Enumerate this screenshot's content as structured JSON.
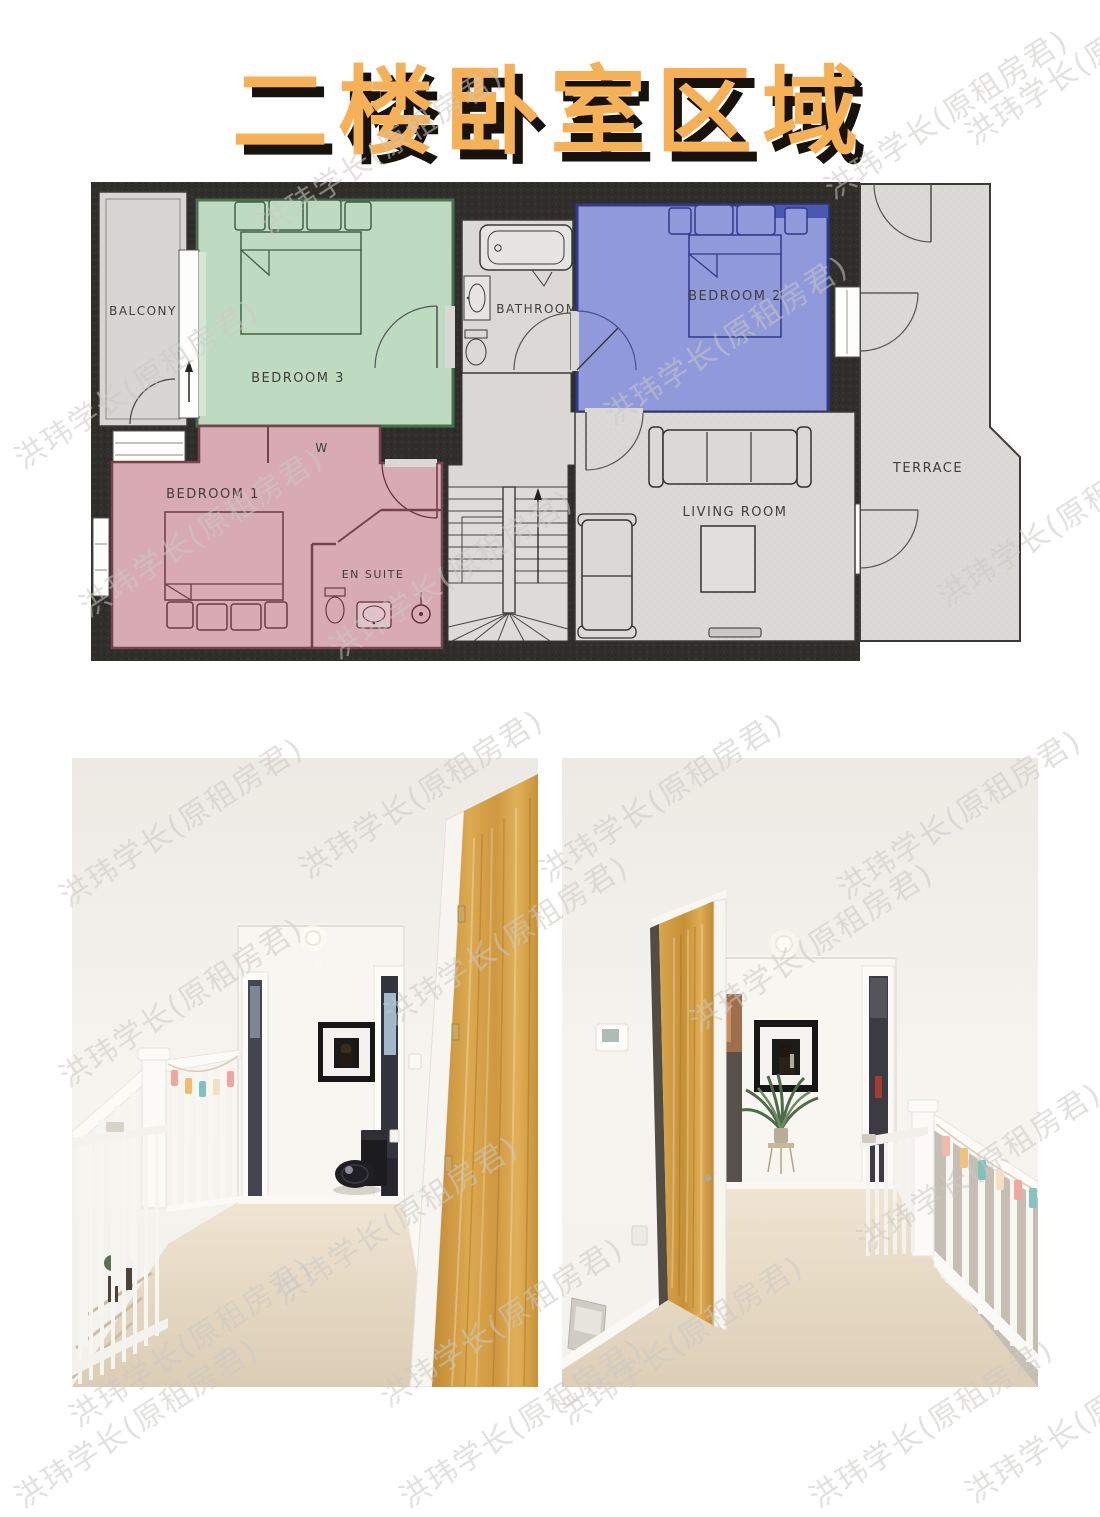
{
  "page": {
    "background": "#FFFFFF",
    "watermark_text": "洪玮学长(原租房君)"
  },
  "title": {
    "text": "二楼卧室区域",
    "color": "#F6B156",
    "shadow_color": "#17120C"
  },
  "floorplan": {
    "wall_color": "#2F2E2B",
    "floor_color": "#DAD9D6",
    "labels": {
      "balcony": "BALCONY",
      "bedroom3": "BEDROOM 3",
      "bathroom": "BATHROOM",
      "bedroom2": "BEDROOM 2",
      "terrace": "TERRACE",
      "bedroom1": "BEDROOM 1",
      "wardrobe": "W",
      "ensuite": "EN SUITE",
      "living_room": "LIVING ROOM"
    },
    "highlight_colors": {
      "bedroom3": "#BEDBC2",
      "bedroom2": "#9099D9",
      "bedroom1": "#D8AAB4"
    }
  }
}
